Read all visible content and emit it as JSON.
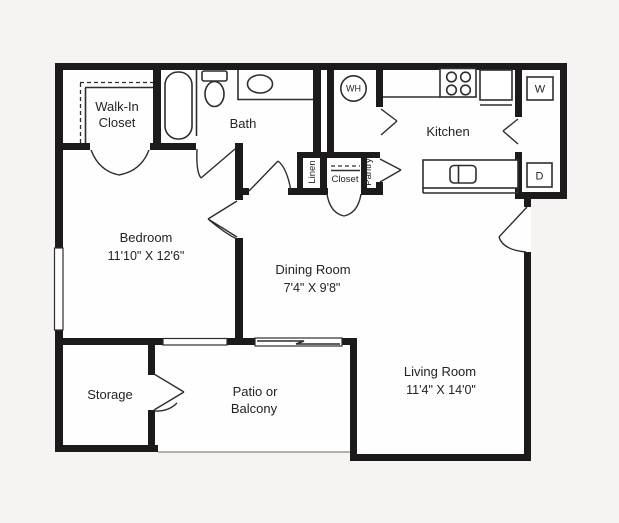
{
  "title": "One bedroom apartment floor plan",
  "colors": {
    "background": "#f5f4f2",
    "wall": "#1c1a1b",
    "floor": "#ffffff",
    "text": "#262223",
    "thin_line": "#2f2c2d"
  },
  "rooms": {
    "walk_in_closet": {
      "line1": "Walk-In",
      "line2": "Closet"
    },
    "bath": {
      "label": "Bath"
    },
    "bedroom": {
      "label": "Bedroom",
      "dimensions": "11'10\" X 12'6\""
    },
    "kitchen": {
      "label": "Kitchen"
    },
    "dining": {
      "label": "Dining Room",
      "dimensions": "7'4\" X 9'8\""
    },
    "living": {
      "label": "Living Room",
      "dimensions": "11'4\" X 14'0\""
    },
    "storage": {
      "label": "Storage"
    },
    "patio": {
      "line1": "Patio or",
      "line2": "Balcony"
    },
    "linen": {
      "label": "Linen"
    },
    "closet": {
      "label": "Closet"
    },
    "pantry": {
      "label": "Pantry"
    }
  },
  "appliances": {
    "water_heater": "WH",
    "washer": "W",
    "dryer": "D"
  }
}
